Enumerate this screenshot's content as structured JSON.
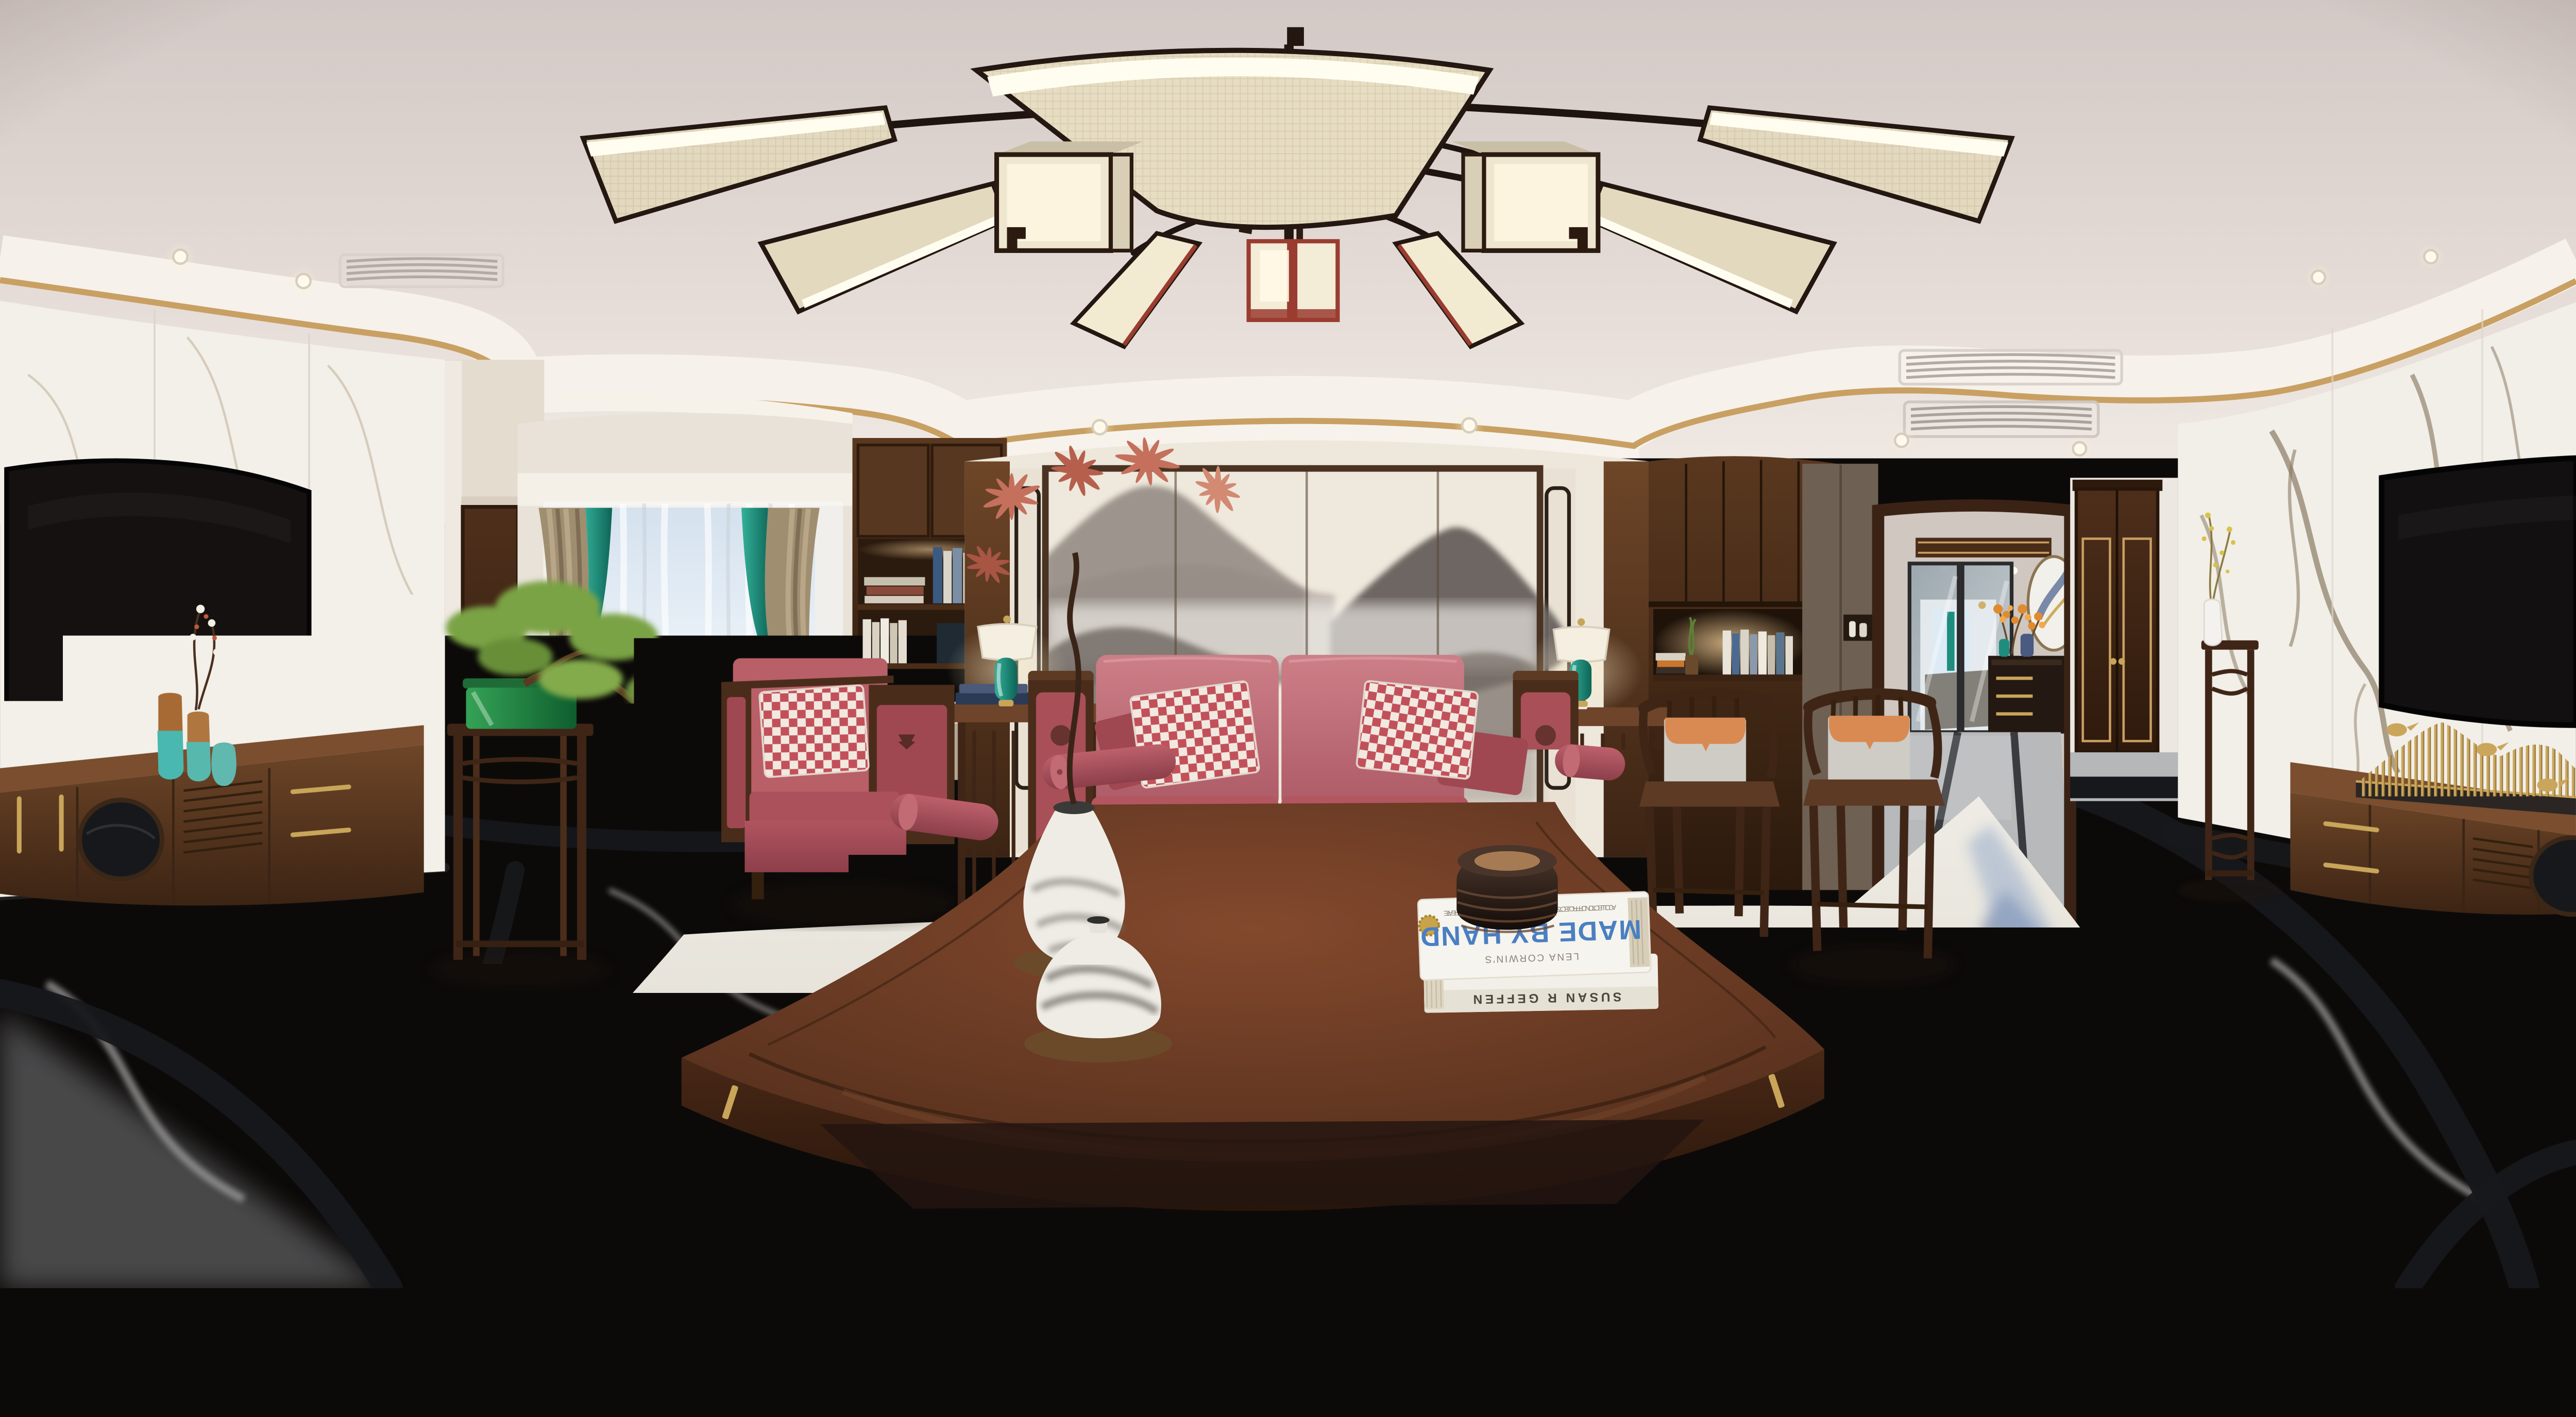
{
  "meta": {
    "description": "360-degree equirectangular panorama render of a new-Chinese-style living room: fan-blade wood chandelier, pink leather sofa with checkered pillows, ink-wash mountain feature wall, fan-shaped dark wood coffee table, wall TVs on marble, bay window with teal-edged drapes, hallway with glass doors, gray marble floor with black inlay and blue ink-wash rug"
  },
  "texts": {
    "tv_brand": "CGAXIS",
    "book_caption": "A COLLECTION OF PROJECTS TO PRINT, SEW, WEAVE, DYE, KNIT, OR OTHERWISE CREATE",
    "book_title": "MADE BY HAND",
    "book_author": "LENA CORWIN'S",
    "book_spine": "SUSAN R GEFFEN"
  },
  "palette": {
    "ceiling": "#e6ddd8",
    "gold_trim": "#c9a063",
    "wall_marble": "#f3efe9",
    "wood_dark": "#42291b",
    "wood_mid": "#5d3b26",
    "sofa_pink": "#c4737c",
    "sofa_red": "#a94f58",
    "checker_red": "#c2505a",
    "accent_teal": "#1f8d7d",
    "cushion_orange": "#d98a52",
    "fabric_beige": "#e7ddc2",
    "painting_ink": "#6e6865",
    "floor_marble": "#c3c4c6",
    "floor_inlay": "#17181c",
    "rug_blue": "#4a639b",
    "book_title_blue": "#4a7fc1",
    "lantern_red": "#9a3c30"
  }
}
